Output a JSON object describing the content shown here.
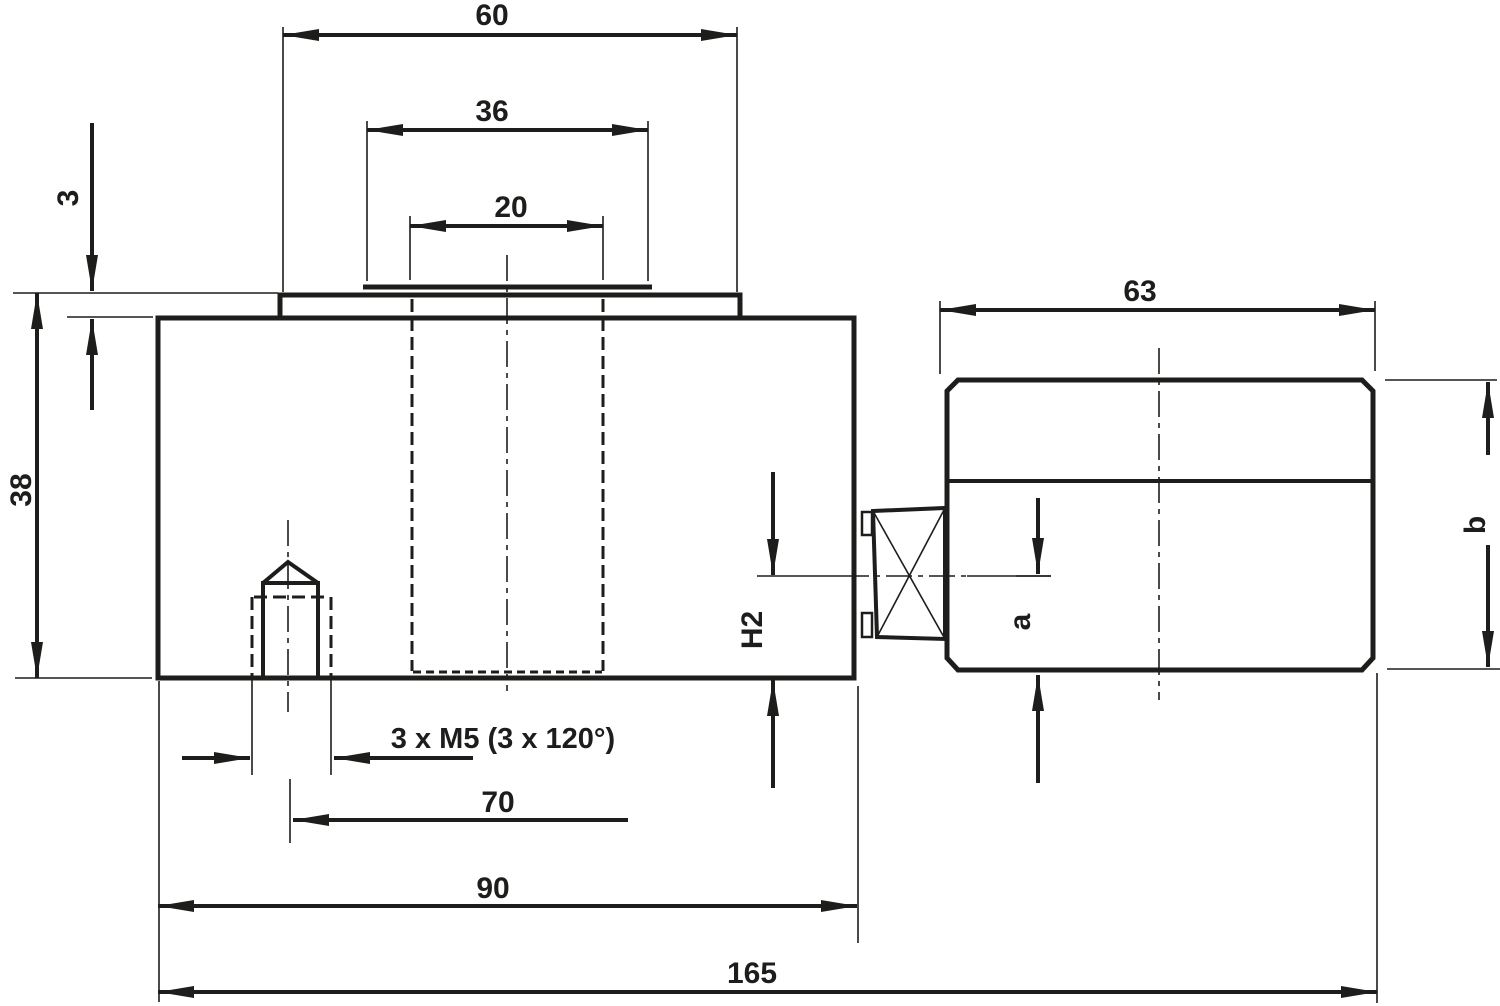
{
  "drawing": {
    "background": "#ffffff",
    "line_color": "#1d1d1b",
    "dimensions": {
      "plate_width": "60",
      "boss_width": "36",
      "hole_width": "20",
      "plate_thickness": "3",
      "body_height": "38",
      "connector_length": "63",
      "thread_callout": "3 x M5 (3 x 120°)",
      "bolt_circle": "70",
      "body_width": "90",
      "overall_length": "165",
      "axis_height_label": "H2",
      "connector_axis_label": "a",
      "connector_height_label": "b"
    }
  }
}
